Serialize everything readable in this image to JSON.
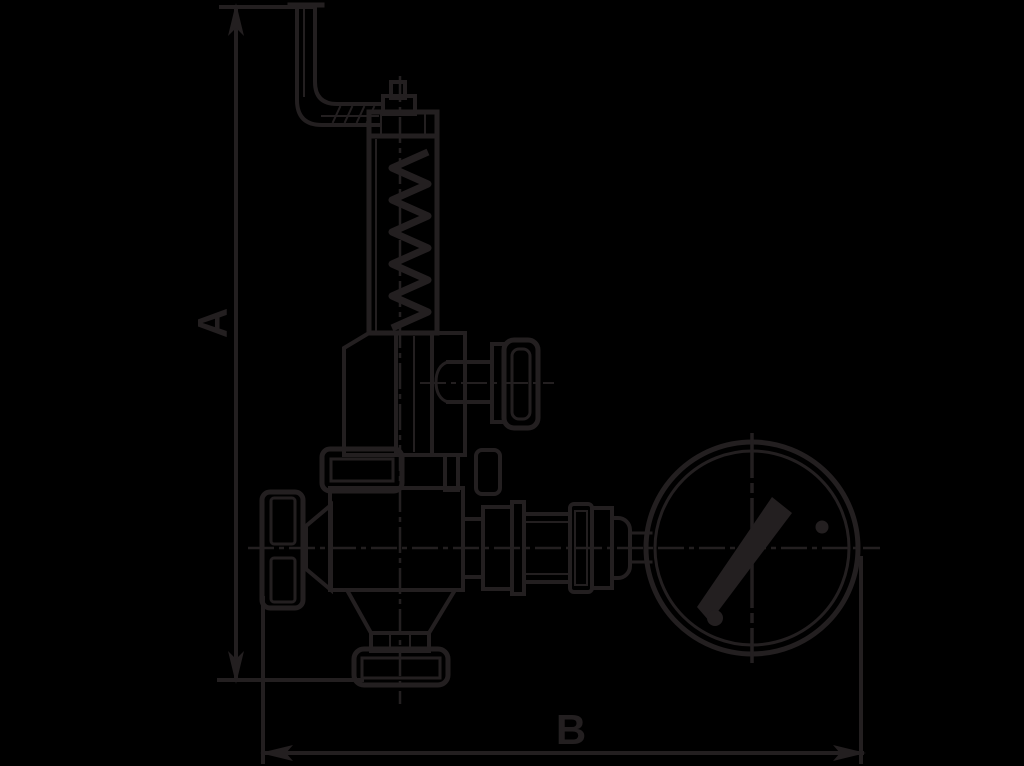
{
  "colors": {
    "background": "#000000",
    "ink": "#231f20"
  },
  "drawing": {
    "type": "technical-line-drawing",
    "subject": "spring-loaded relief valve with handwheel, test knob, bottom flange and pressure gauge, side view",
    "dimension_labels": {
      "vertical": "A",
      "horizontal": "B"
    }
  }
}
